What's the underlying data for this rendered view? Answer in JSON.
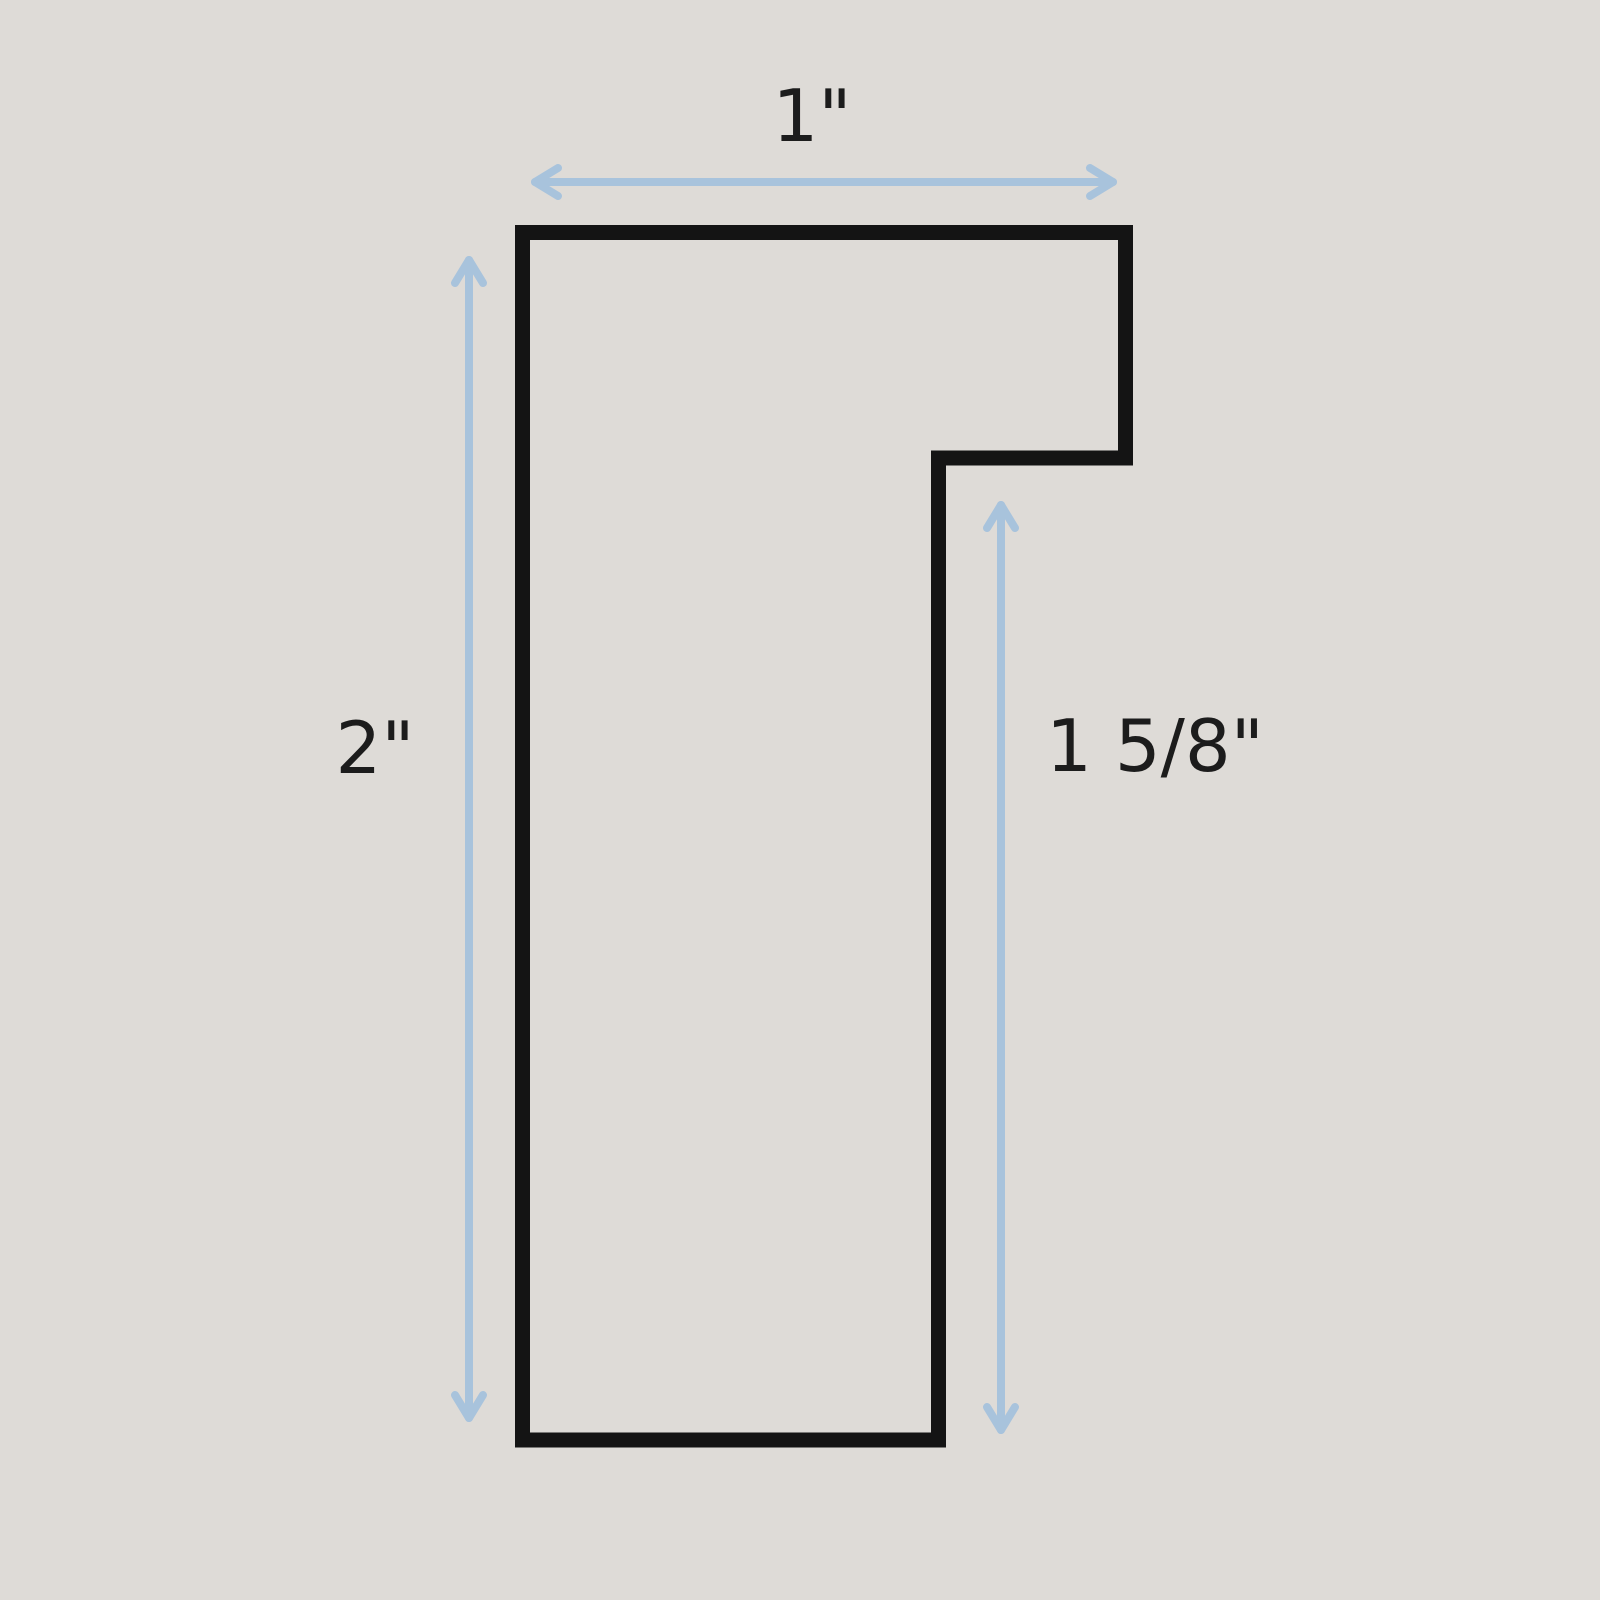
{
  "diagram": {
    "type": "cross-section profile drawing (frame moulding)",
    "background_color": "#dedbd7",
    "outline_color": "#141414",
    "arrow_color": "#a8c3dc",
    "label_color": "#1c1c1c",
    "dimensions": {
      "top_width": "1\"",
      "left_height": "2\"",
      "right_rabbet_height": "1 5/8\""
    }
  }
}
